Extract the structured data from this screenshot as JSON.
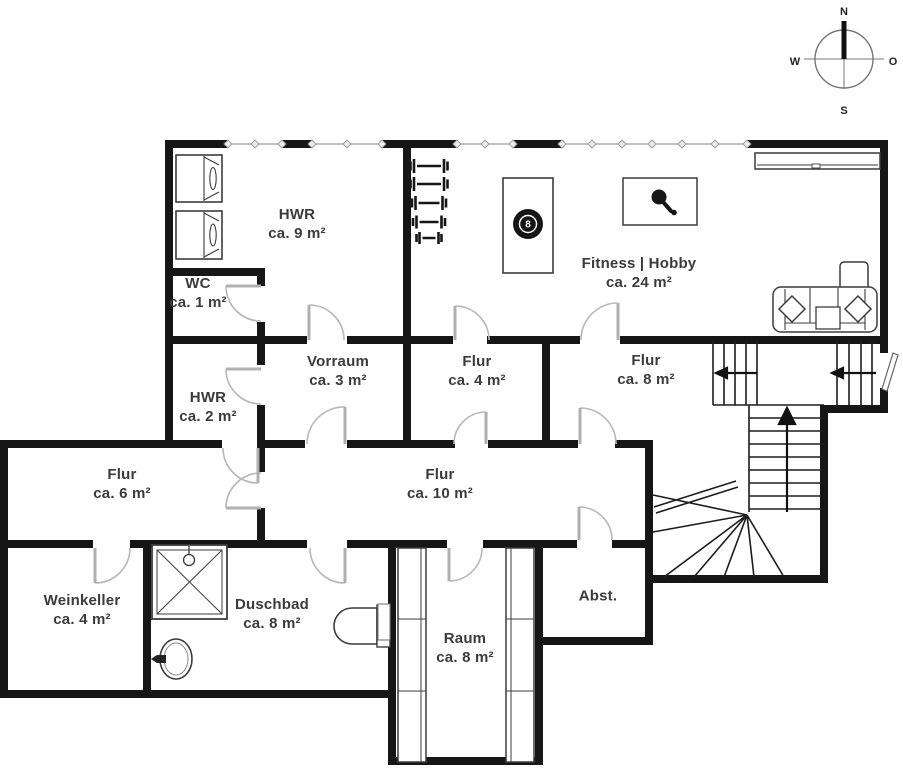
{
  "title": "Kellergeschoss Grundriss",
  "rooms": [
    {
      "name": "HWR",
      "area": "ca. 9 m²",
      "x": 297,
      "y": 224
    },
    {
      "name": "WC",
      "area": "ca. 1 m²",
      "x": 198,
      "y": 293
    },
    {
      "name": "Fitness | Hobby",
      "area": "ca. 24 m²",
      "x": 639,
      "y": 273
    },
    {
      "name": "Vorraum",
      "area": "ca. 3 m²",
      "x": 338,
      "y": 371
    },
    {
      "name": "Flur",
      "area": "ca. 4 m²",
      "x": 477,
      "y": 371
    },
    {
      "name": "Flur",
      "area": "ca. 8 m²",
      "x": 646,
      "y": 370
    },
    {
      "name": "HWR",
      "area": "ca. 2 m²",
      "x": 208,
      "y": 407
    },
    {
      "name": "Flur",
      "area": "ca. 6 m²",
      "x": 122,
      "y": 484
    },
    {
      "name": "Flur",
      "area": "ca. 10 m²",
      "x": 440,
      "y": 484
    },
    {
      "name": "Weinkeller",
      "area": "ca. 4 m²",
      "x": 82,
      "y": 610
    },
    {
      "name": "Duschbad",
      "area": "ca. 8 m²",
      "x": 272,
      "y": 614
    },
    {
      "name": "Abst.",
      "area": "",
      "x": 598,
      "y": 596
    },
    {
      "name": "Raum",
      "area": "ca. 8 m²",
      "x": 465,
      "y": 648
    }
  ],
  "compass": {
    "north": "N",
    "east": "O",
    "south": "S",
    "west": "W"
  },
  "billiard_ball_label": "8",
  "colors": {
    "wall": "#161616",
    "background": "#ffffff",
    "label_text": "#3b3b3b",
    "door_arc": "#b8b8b8",
    "window_line": "#adadad"
  }
}
